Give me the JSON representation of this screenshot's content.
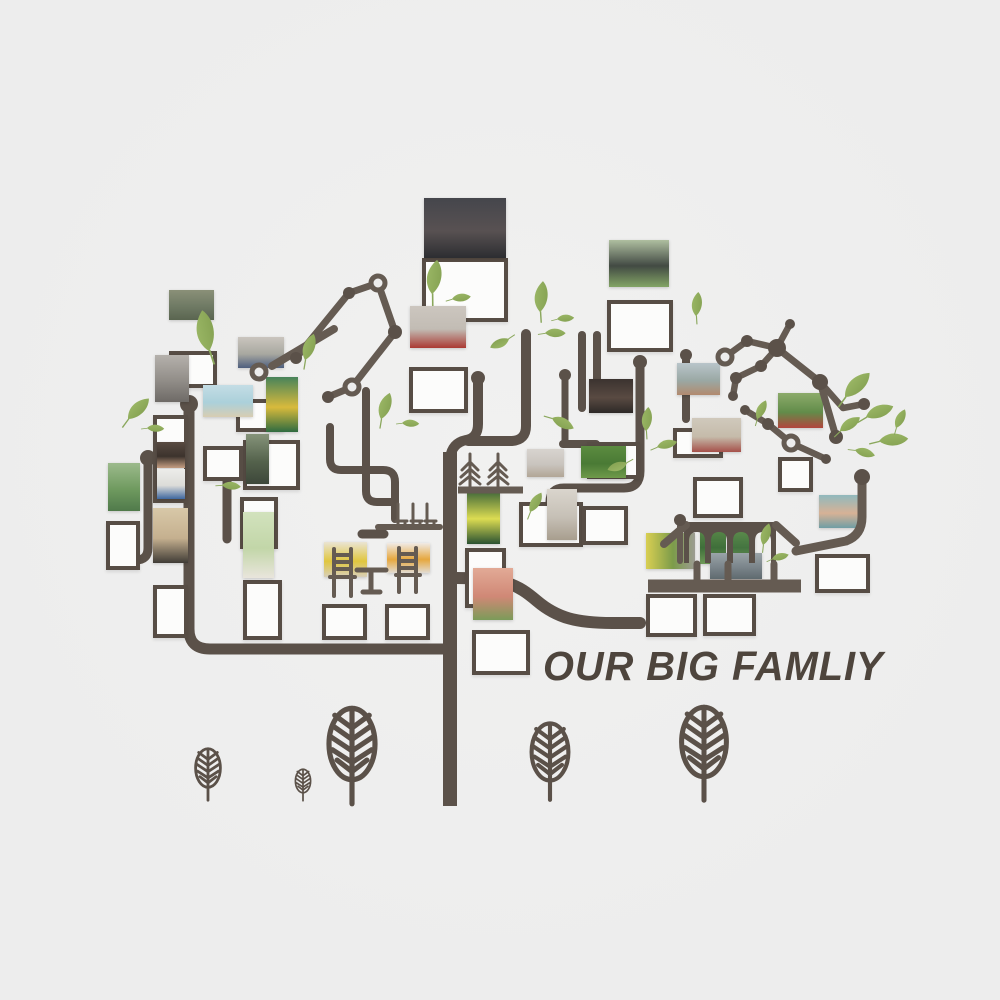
{
  "title": {
    "text": "OUR BIG FAMLIY",
    "x": 543,
    "y": 643,
    "size": 41,
    "color": "#4e453d"
  },
  "palette": {
    "background": "#ededed",
    "branch": "#5b5149",
    "constellation": "#655b52",
    "frame_border": "#574d45",
    "frame_fill": "#fcfcfb",
    "leaf_light": "#a2be6c",
    "leaf_dark": "#7d9a4b",
    "text": "#4e453d"
  },
  "photos": [
    {
      "id": "family-group-studio",
      "x": 424,
      "y": 198,
      "w": 82,
      "h": 60,
      "colors": [
        "#45464c",
        "#585152",
        "#2c2d31"
      ]
    },
    {
      "id": "red-team-building",
      "x": 410,
      "y": 306,
      "w": 56,
      "h": 42,
      "colors": [
        "#ccc6bf",
        "#c2bcb4",
        "#ab3a33"
      ]
    },
    {
      "id": "military-parade",
      "x": 169,
      "y": 290,
      "w": 45,
      "h": 30,
      "colors": [
        "#8a9078",
        "#6f7a64",
        "#5a6550"
      ]
    },
    {
      "id": "school-group",
      "x": 238,
      "y": 337,
      "w": 46,
      "h": 31,
      "colors": [
        "#cac5be",
        "#a8a8a0",
        "#4e5f7e"
      ]
    },
    {
      "id": "graduation-caps",
      "x": 609,
      "y": 240,
      "w": 60,
      "h": 47,
      "colors": [
        "#afbfa0",
        "#424a43",
        "#83a465"
      ]
    },
    {
      "id": "street-alley",
      "x": 155,
      "y": 355,
      "w": 34,
      "h": 47,
      "colors": [
        "#b5b1ac",
        "#918d88",
        "#6e6a66"
      ]
    },
    {
      "id": "beach-pair",
      "x": 203,
      "y": 385,
      "w": 50,
      "h": 32,
      "colors": [
        "#c4dde5",
        "#abd0da",
        "#d8cdb2"
      ]
    },
    {
      "id": "soccer-kid",
      "x": 266,
      "y": 377,
      "w": 32,
      "h": 55,
      "colors": [
        "#47835b",
        "#d8ba3c",
        "#2f6b40"
      ]
    },
    {
      "id": "kid-climbing",
      "x": 246,
      "y": 434,
      "w": 23,
      "h": 50,
      "colors": [
        "#86947a",
        "#54624c",
        "#3d473a"
      ]
    },
    {
      "id": "boy-indoor",
      "x": 157,
      "y": 442,
      "w": 28,
      "h": 26,
      "colors": [
        "#584a41",
        "#3c332d",
        "#c59e82"
      ]
    },
    {
      "id": "boy-certificate",
      "x": 157,
      "y": 469,
      "w": 28,
      "h": 30,
      "colors": [
        "#ededea",
        "#dcdcd8",
        "#3f68a0"
      ]
    },
    {
      "id": "mountain-runners",
      "x": 108,
      "y": 463,
      "w": 32,
      "h": 48,
      "colors": [
        "#9cba8c",
        "#6f9a5f",
        "#507a4b"
      ]
    },
    {
      "id": "boy-on-sand",
      "x": 153,
      "y": 508,
      "w": 35,
      "h": 55,
      "colors": [
        "#d8c8a8",
        "#c5b08f",
        "#403c36"
      ]
    },
    {
      "id": "newborn-baby",
      "x": 243,
      "y": 512,
      "w": 31,
      "h": 66,
      "colors": [
        "#d2e2bd",
        "#c2d6a8",
        "#e9e5dc"
      ]
    },
    {
      "id": "kid-at-chair",
      "x": 324,
      "y": 542,
      "w": 43,
      "h": 35,
      "colors": [
        "#eae4d3",
        "#e0c63e",
        "#d8cfb9"
      ]
    },
    {
      "id": "flower-painting",
      "x": 387,
      "y": 543,
      "w": 43,
      "h": 30,
      "colors": [
        "#f0eae5",
        "#e6a73e",
        "#e2dcd3"
      ]
    },
    {
      "id": "kid-yellow-vest",
      "x": 467,
      "y": 488,
      "w": 33,
      "h": 56,
      "colors": [
        "#2e5a36",
        "#dcdc52",
        "#2a5232"
      ]
    },
    {
      "id": "baby-face",
      "x": 473,
      "y": 568,
      "w": 40,
      "h": 52,
      "colors": [
        "#e2aa96",
        "#d08876",
        "#7b9b59"
      ]
    },
    {
      "id": "kids-blurry",
      "x": 527,
      "y": 449,
      "w": 37,
      "h": 28,
      "colors": [
        "#d8d4cf",
        "#c9c4be",
        "#b2a696"
      ]
    },
    {
      "id": "field-kids",
      "x": 581,
      "y": 446,
      "w": 45,
      "h": 32,
      "colors": [
        "#5c8c40",
        "#4a7a35",
        "#6f9a4a"
      ]
    },
    {
      "id": "mother-child",
      "x": 547,
      "y": 489,
      "w": 30,
      "h": 51,
      "colors": [
        "#dad5cd",
        "#c6c0b6",
        "#a89e8e"
      ]
    },
    {
      "id": "man-on-sofa",
      "x": 589,
      "y": 379,
      "w": 44,
      "h": 34,
      "colors": [
        "#3b332f",
        "#594a42",
        "#2d2927"
      ]
    },
    {
      "id": "track-field-kids",
      "x": 677,
      "y": 363,
      "w": 43,
      "h": 32,
      "colors": [
        "#b9c5ca",
        "#9aa8a4",
        "#b28a6e"
      ]
    },
    {
      "id": "sports-meeting",
      "x": 778,
      "y": 393,
      "w": 45,
      "h": 35,
      "colors": [
        "#8cab6a",
        "#628c4a",
        "#b2453d"
      ]
    },
    {
      "id": "kindergarten-group",
      "x": 692,
      "y": 418,
      "w": 49,
      "h": 34,
      "colors": [
        "#d0c9bc",
        "#c5bbaa",
        "#a6504a"
      ]
    },
    {
      "id": "park-walk",
      "x": 646,
      "y": 533,
      "w": 49,
      "h": 36,
      "dir": 90,
      "colors": [
        "#d9cf52",
        "#7c9c4a",
        "#9c9c92"
      ]
    },
    {
      "id": "baby-knit-hat",
      "x": 819,
      "y": 495,
      "w": 40,
      "h": 33,
      "colors": [
        "#90b9bd",
        "#d7b296",
        "#6f9ea4"
      ]
    },
    {
      "id": "arch-greenery-1",
      "x": 700,
      "y": 528,
      "w": 26,
      "h": 36,
      "colors": [
        "#5a8a4a",
        "#3f6f3a",
        "#6f9a58"
      ]
    },
    {
      "id": "arch-greenery-2",
      "x": 729,
      "y": 528,
      "w": 26,
      "h": 36,
      "colors": [
        "#5f8f4e",
        "#447440",
        "#74a05c"
      ]
    },
    {
      "id": "arch-figures",
      "x": 710,
      "y": 553,
      "w": 52,
      "h": 26,
      "colors": [
        "#9aa4a8",
        "#7a848a",
        "#5f6a6f"
      ]
    }
  ],
  "frames": [
    {
      "x": 422,
      "y": 258,
      "w": 86,
      "h": 64
    },
    {
      "x": 607,
      "y": 300,
      "w": 66,
      "h": 52
    },
    {
      "x": 169,
      "y": 351,
      "w": 48,
      "h": 37
    },
    {
      "x": 236,
      "y": 399,
      "w": 48,
      "h": 33
    },
    {
      "x": 243,
      "y": 440,
      "w": 57,
      "h": 50
    },
    {
      "x": 203,
      "y": 446,
      "w": 40,
      "h": 35
    },
    {
      "x": 153,
      "y": 415,
      "w": 35,
      "h": 88
    },
    {
      "x": 106,
      "y": 521,
      "w": 34,
      "h": 49
    },
    {
      "x": 153,
      "y": 585,
      "w": 35,
      "h": 53
    },
    {
      "x": 243,
      "y": 580,
      "w": 39,
      "h": 60
    },
    {
      "x": 322,
      "y": 604,
      "w": 45,
      "h": 36
    },
    {
      "x": 385,
      "y": 604,
      "w": 45,
      "h": 36
    },
    {
      "x": 472,
      "y": 630,
      "w": 58,
      "h": 45
    },
    {
      "x": 465,
      "y": 548,
      "w": 41,
      "h": 60
    },
    {
      "x": 519,
      "y": 502,
      "w": 64,
      "h": 45
    },
    {
      "x": 582,
      "y": 506,
      "w": 46,
      "h": 39
    },
    {
      "x": 587,
      "y": 442,
      "w": 53,
      "h": 37
    },
    {
      "x": 693,
      "y": 477,
      "w": 50,
      "h": 41
    },
    {
      "x": 778,
      "y": 457,
      "w": 35,
      "h": 35
    },
    {
      "x": 815,
      "y": 554,
      "w": 55,
      "h": 39
    },
    {
      "x": 646,
      "y": 594,
      "w": 51,
      "h": 43
    },
    {
      "x": 703,
      "y": 594,
      "w": 53,
      "h": 42
    },
    {
      "x": 409,
      "y": 367,
      "w": 59,
      "h": 46
    },
    {
      "x": 673,
      "y": 428,
      "w": 50,
      "h": 30
    },
    {
      "x": 240,
      "y": 497,
      "w": 38,
      "h": 52
    }
  ],
  "branches_back": {
    "strokes": [
      {
        "name": "trunk",
        "d": "M450,806 L450,452",
        "w": 14,
        "cap": "butt"
      },
      {
        "name": "trunk-fork-left",
        "d": "M478,382 L478,424 Q478,438 466,440 Q452,443 450,458",
        "w": 10
      },
      {
        "name": "trunk-fork-center",
        "d": "M526,334 L526,426 Q526,440 512,441 L468,441",
        "w": 10
      },
      {
        "name": "branch-left-main",
        "d": "M443,649 L210,649 Q189,649 189,629 L189,412",
        "w": 11
      },
      {
        "name": "branch-left-vertical",
        "d": "M148,462 L148,548 Q148,560 136,560 L118,560",
        "w": 9
      },
      {
        "name": "branch-shelf-left",
        "d": "M330,427 L330,459 Q330,470 341,470 L383,470 Q395,470 395,482 L395,519",
        "w": 8
      },
      {
        "name": "branch-shelf-drop",
        "d": "M366,391 L366,491 Q366,502 377,502 L391,502",
        "w": 8
      },
      {
        "name": "branch-stub-a",
        "d": "M362,534 L384,534",
        "w": 9
      },
      {
        "name": "branch-stub-b",
        "d": "M227,462 L227,539",
        "w": 9
      },
      {
        "name": "branch-right-drop",
        "d": "M640,366 L640,471 Q640,488 624,488 L564,488 Q550,488 550,502 L550,517",
        "w": 9
      },
      {
        "name": "branch-right-twig",
        "d": "M686,360 L686,419",
        "w": 8
      },
      {
        "name": "branch-upright-a",
        "d": "M582,335 L582,408",
        "w": 8
      },
      {
        "name": "branch-upright-b",
        "d": "M597,335 L597,408",
        "w": 8
      },
      {
        "name": "branch-upright-join",
        "d": "M563,444 L596,444",
        "w": 8
      },
      {
        "name": "branch-upright-c",
        "d": "M565,379 L565,443",
        "w": 7
      },
      {
        "name": "branch-bottom-right",
        "d": "M456,578 C505,578 517,584 537,601 C557,618 577,623 612,623 L640,623",
        "w": 12
      }
    ],
    "dots": [
      [
        478,
        378,
        7
      ],
      [
        189,
        404,
        9
      ],
      [
        640,
        362,
        7
      ],
      [
        686,
        355,
        6
      ],
      [
        565,
        375,
        6
      ],
      [
        148,
        458,
        8
      ]
    ]
  },
  "overlay": {
    "strokes": [
      {
        "name": "constellation-left-a",
        "d": "M296,358 L349,293 L378,283",
        "w": 7
      },
      {
        "name": "constellation-left-b",
        "d": "M378,283 L395,332 L352,387 L328,397",
        "w": 7
      },
      {
        "name": "twig-diagonal-left",
        "d": "M334,329 L272,366",
        "w": 8
      },
      {
        "name": "constellation-right-a",
        "d": "M790,324 L777,348 L747,341 L725,357",
        "w": 6.5
      },
      {
        "name": "constellation-right-b",
        "d": "M777,348 L761,366 L736,378 L733,396",
        "w": 6.5
      },
      {
        "name": "constellation-right-c",
        "d": "M777,348 L820,382 L836,437",
        "w": 7
      },
      {
        "name": "constellation-right-d",
        "d": "M820,382 L843,408 L864,404",
        "w": 6.5
      },
      {
        "name": "constellation-right-e",
        "d": "M745,410 L768,424 L791,443 L826,459",
        "w": 6.5
      },
      {
        "name": "pavilion-branch-right",
        "d": "M862,483 L862,517 Q862,535 846,541 L796,551",
        "w": 9
      },
      {
        "name": "pavilion-post-left",
        "d": "M680,526 L680,561",
        "w": 6
      },
      {
        "name": "pavilion-beam-left",
        "d": "M664,544 L686,525",
        "w": 8
      },
      {
        "name": "pavilion-beam-right",
        "d": "M776,525 L796,543",
        "w": 8
      },
      {
        "name": "pavilion-base",
        "d": "M648,586 L801,586",
        "w": 13,
        "cap": "butt"
      },
      {
        "name": "pavilion-foot-1",
        "d": "M697,564 L697,580",
        "w": 7
      },
      {
        "name": "pavilion-foot-2",
        "d": "M728,564 L728,580",
        "w": 7
      },
      {
        "name": "pavilion-foot-3",
        "d": "M774,564 L774,580",
        "w": 7
      },
      {
        "name": "chair-silhouette-1",
        "d": "M334,549 L334,576 M351,549 L351,576 M334,555 L351,555 M334,562 L351,562 M334,569 L351,569 M330,577 L355,577 M334,578 L334,596 M351,578 L351,596",
        "w": 4
      },
      {
        "name": "table-silhouette",
        "d": "M357,570 L386,570 M371,571 L371,590 M363,592 L380,592",
        "w": 5
      },
      {
        "name": "chair-silhouette-2",
        "d": "M399,548 L399,574 M416,548 L416,574 M399,554 L416,554 M399,561 L416,561 M399,568 L416,568 M396,575 L420,575 M399,576 L399,592 M416,576 L416,592",
        "w": 4
      },
      {
        "name": "shelf-bar",
        "d": "M378,527 L440,527",
        "w": 6
      },
      {
        "name": "mini-chairs",
        "d": "M398,504 L398,521 M396,521 L407,521 M398,522 L398,526 M405,522 L405,526 M413,504 L413,521 M411,521 L422,521 M413,522 L413,526 M420,522 L420,526 M427,504 L427,521 M425,521 L436,521 M427,522 L427,526 M434,522 L434,526",
        "w": 3
      },
      {
        "name": "planter-bar",
        "d": "M458,490 L523,490",
        "w": 7,
        "cap": "butt"
      },
      {
        "name": "pine-tree-1",
        "d": "M470,454 L470,487 M462,470 L470,462 L478,470 M461,477 L470,469 L479,477 M460,484 L470,476 L480,484",
        "w": 3
      },
      {
        "name": "pine-tree-2",
        "d": "M498,454 L498,487 M490,470 L498,462 L506,470 M489,477 L498,469 L507,477 M488,484 L498,476 L508,484",
        "w": 3
      }
    ],
    "fills": [
      {
        "name": "pavilion-wall",
        "rule": "evenodd",
        "d": "M684,522 L776,522 L776,563 L684,563 Z M689,563 L689,541 Q689,532 697,532 Q705,532 705,541 L705,563 Z M711,563 L711,541 Q711,532 719,532 Q727,532 727,541 L727,563 Z M733,563 L733,541 Q733,532 741,532 Q749,532 749,541 L749,563 Z M755,563 L755,541 Q755,532 763,532 Q771,532 771,541 L771,563 Z"
      }
    ],
    "dots": [
      [
        862,
        477,
        8
      ],
      [
        680,
        520,
        6
      ],
      [
        296,
        358,
        6
      ],
      [
        349,
        293,
        6
      ],
      [
        395,
        332,
        7
      ],
      [
        328,
        397,
        6
      ],
      [
        790,
        324,
        5
      ],
      [
        747,
        341,
        6
      ],
      [
        777,
        348,
        9
      ],
      [
        761,
        366,
        6
      ],
      [
        736,
        378,
        6
      ],
      [
        733,
        396,
        5
      ],
      [
        820,
        382,
        8
      ],
      [
        836,
        437,
        7
      ],
      [
        864,
        404,
        6
      ],
      [
        768,
        424,
        6
      ],
      [
        745,
        410,
        5
      ],
      [
        826,
        459,
        5
      ]
    ],
    "rings": [
      [
        378,
        283,
        7
      ],
      [
        352,
        387,
        7
      ],
      [
        259,
        372,
        7
      ],
      [
        725,
        357,
        7
      ],
      [
        791,
        443,
        7
      ]
    ]
  },
  "leaves": [
    [
      209,
      351,
      -70,
      1.2
    ],
    [
      128,
      419,
      -15,
      0.85
    ],
    [
      147,
      428,
      32,
      0.5
    ],
    [
      305,
      360,
      -42,
      0.8
    ],
    [
      432,
      294,
      -52,
      1.0
    ],
    [
      452,
      299,
      22,
      0.55
    ],
    [
      540,
      312,
      -55,
      0.9
    ],
    [
      509,
      339,
      185,
      0.6
    ],
    [
      545,
      333,
      30,
      0.6
    ],
    [
      552,
      418,
      55,
      0.7
    ],
    [
      381,
      419,
      -42,
      0.8
    ],
    [
      402,
      423,
      32,
      0.5
    ],
    [
      530,
      512,
      -30,
      0.65
    ],
    [
      646,
      431,
      -55,
      0.7
    ],
    [
      657,
      447,
      15,
      0.6
    ],
    [
      696,
      316,
      -55,
      0.7
    ],
    [
      845,
      397,
      -15,
      1.0
    ],
    [
      866,
      417,
      8,
      0.85
    ],
    [
      840,
      431,
      -5,
      0.7
    ],
    [
      879,
      441,
      25,
      0.85
    ],
    [
      896,
      428,
      -35,
      0.6
    ],
    [
      855,
      450,
      45,
      0.6
    ],
    [
      757,
      419,
      -35,
      0.6
    ],
    [
      627,
      463,
      190,
      0.6
    ],
    [
      222,
      485,
      35,
      0.55
    ],
    [
      763,
      545,
      -45,
      0.65
    ],
    [
      772,
      559,
      15,
      0.5
    ],
    [
      557,
      319,
      25,
      0.5
    ]
  ],
  "saplings": [
    [
      208,
      768,
      0.62
    ],
    [
      303,
      781,
      0.38
    ],
    [
      352,
      744,
      1.15
    ],
    [
      550,
      752,
      0.92
    ],
    [
      704,
      742,
      1.12
    ]
  ]
}
